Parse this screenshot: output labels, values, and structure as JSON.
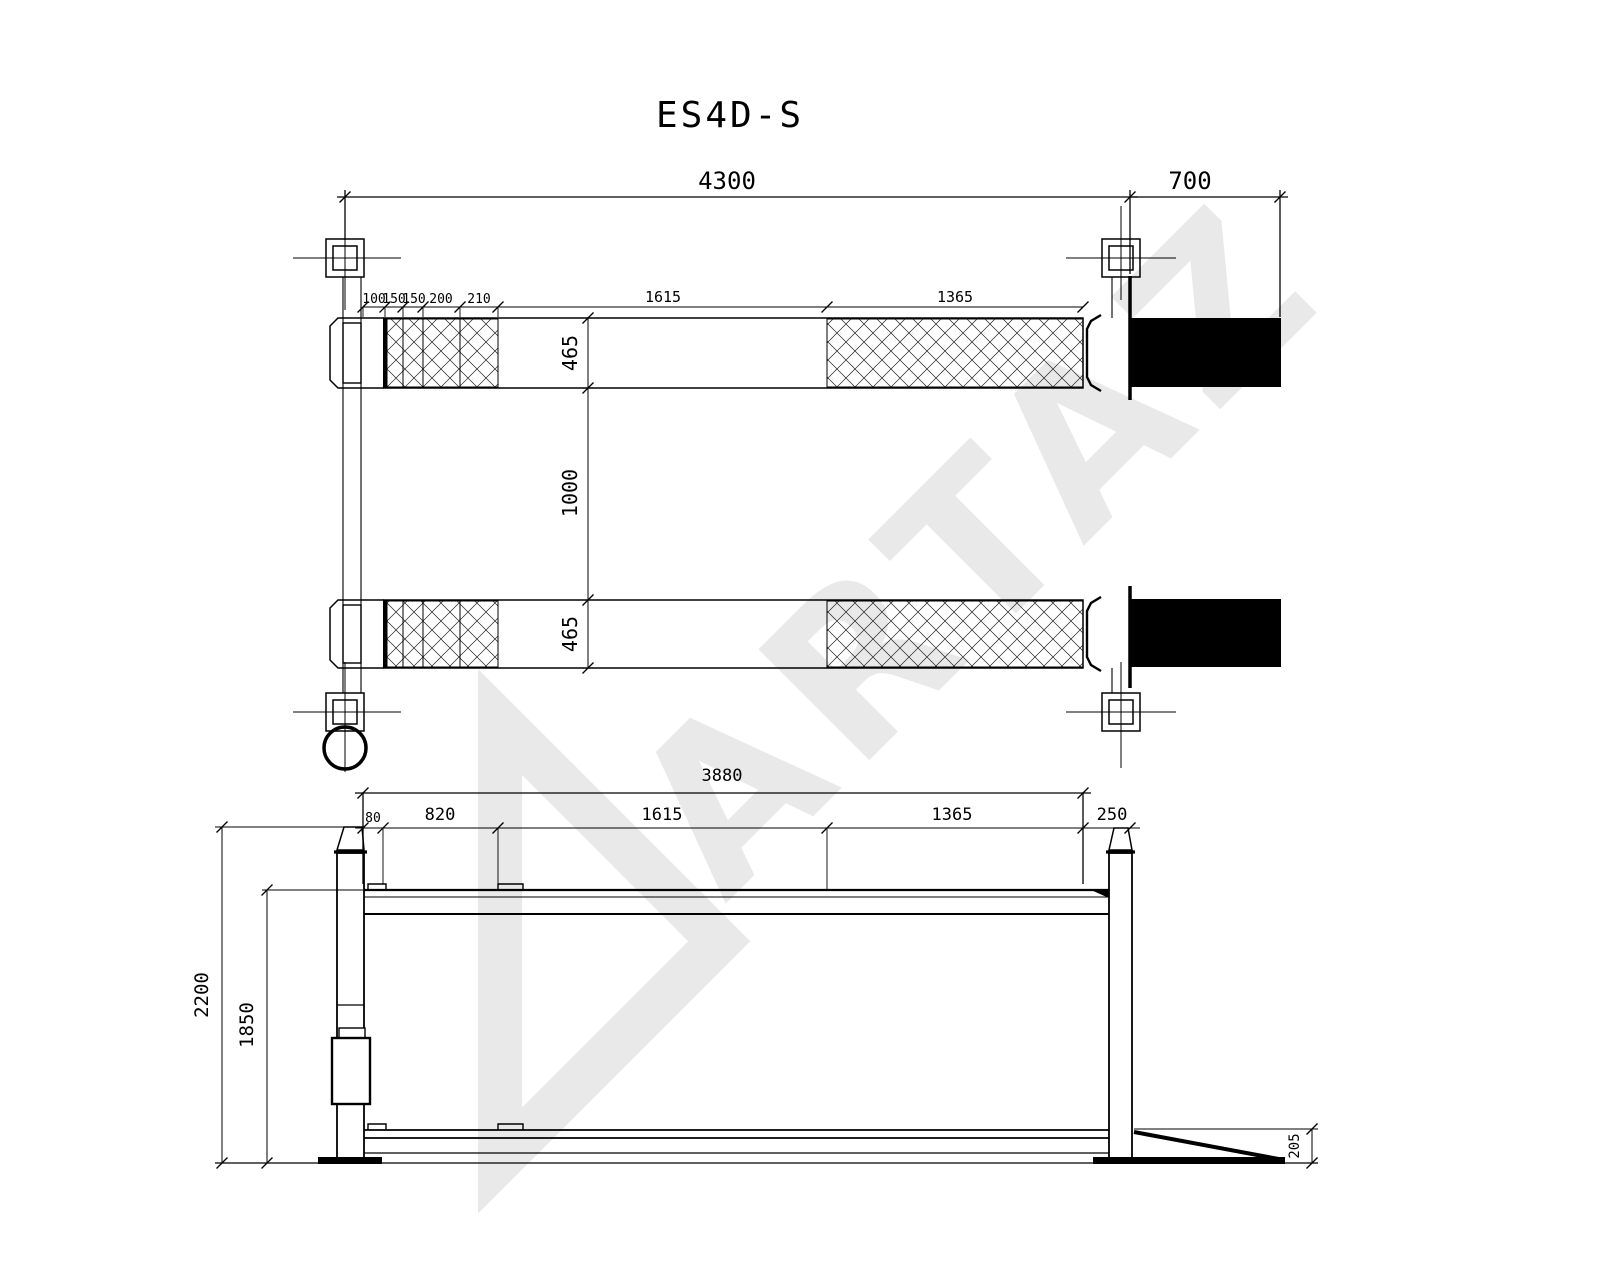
{
  "title": "ES4D-S",
  "watermark": {
    "text": "ARTAZ"
  },
  "top_view": {
    "dim_overall": "4300",
    "dim_ramp": "700",
    "dim_segments": [
      "100",
      "150",
      "150",
      "200",
      "210",
      "1615",
      "1365"
    ],
    "dim_track_width_top": "465",
    "dim_track_gap": "1000",
    "dim_track_width_bottom": "465"
  },
  "side_view": {
    "dim_total": "3880",
    "dim_segments": [
      "80",
      "820",
      "1615",
      "1365"
    ],
    "dim_ledge": "250",
    "dim_height_overall": "2200",
    "dim_height_platform": "1850",
    "dim_ramp_height": "205"
  }
}
